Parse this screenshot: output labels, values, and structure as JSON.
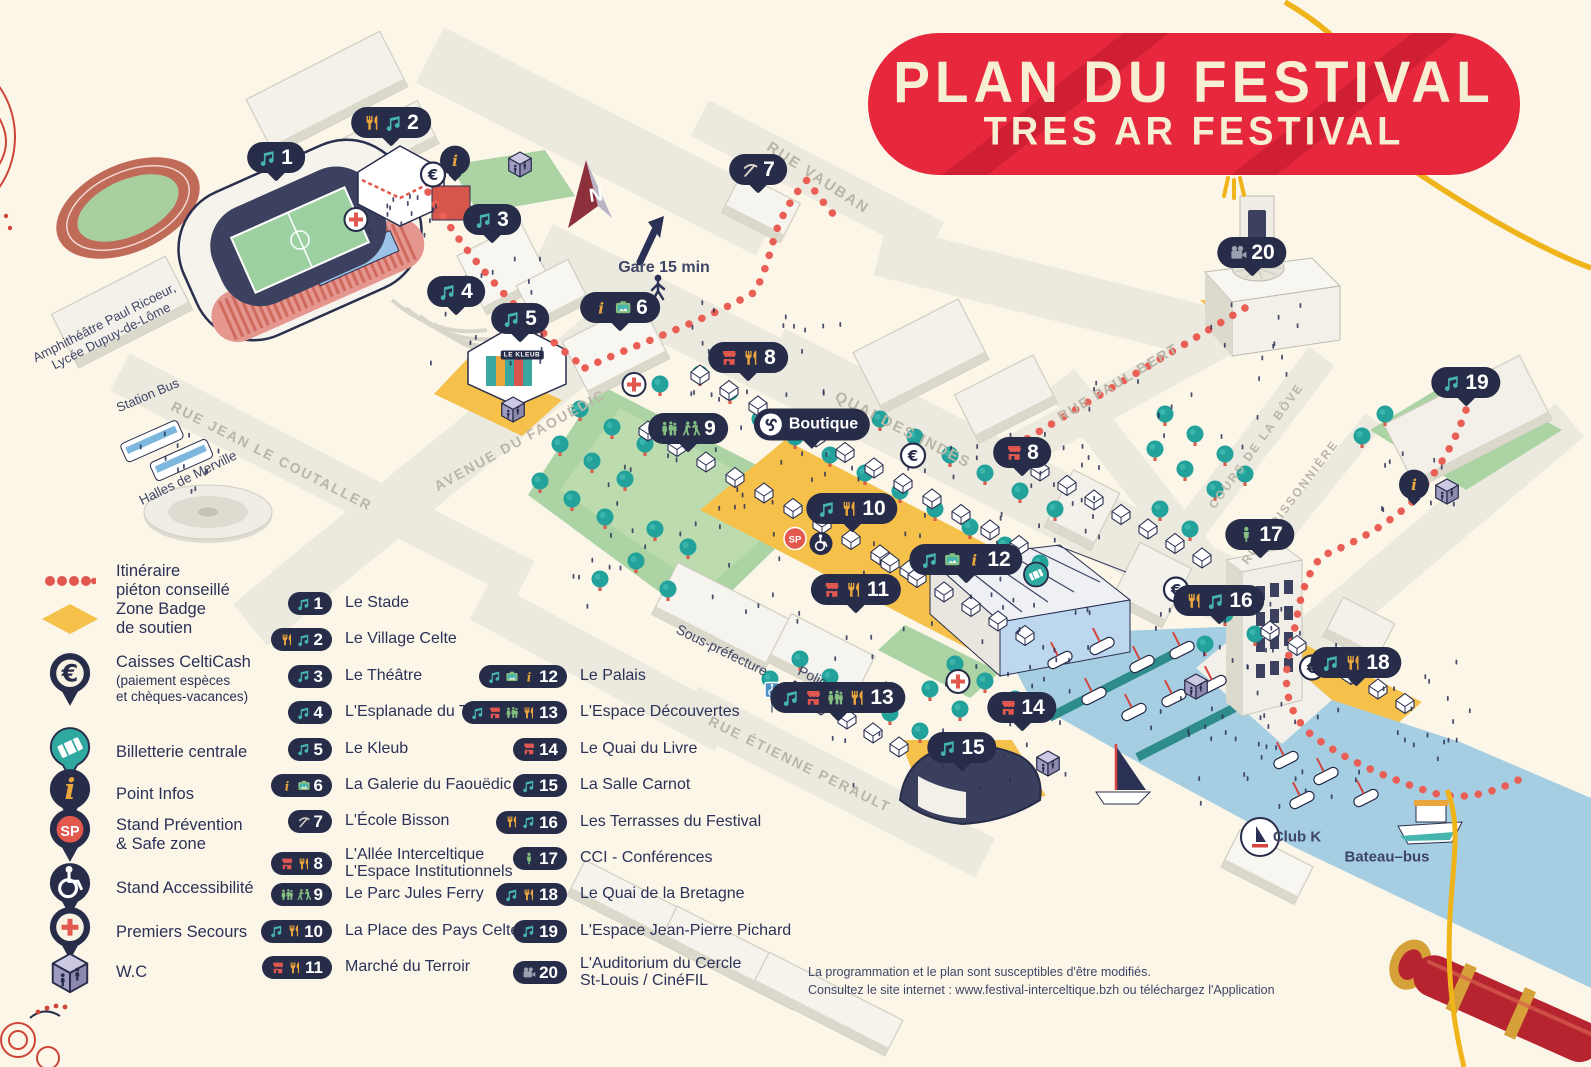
{
  "title": {
    "line1": "PLAN DU FESTIVAL",
    "line2": "TRES AR FESTIVAL"
  },
  "colors": {
    "banner_red": "#e7273c",
    "navy": "#272c49",
    "teal": "#45b5ad",
    "gold": "#eaa53d",
    "icon_red": "#e2574e",
    "icon_green": "#84bd80",
    "cream": "#fbf6e8",
    "water": "#a6cee2",
    "badge_yellow": "#f5c14b",
    "dotted_red": "#ea5f55"
  },
  "legend": {
    "items": [
      {
        "icon": "dotted-path",
        "label": [
          "Itinéraire",
          "piéton conseillé"
        ]
      },
      {
        "icon": "badge-zone",
        "label": [
          "Zone Badge",
          "de soutien"
        ]
      },
      {
        "icon": "euro-pin",
        "label": [
          "Caisses CeltiCash"
        ],
        "sub": [
          "(paiement espèces",
          "et chèques-vacances)"
        ]
      },
      {
        "icon": "ticket-pin",
        "label": [
          "Billetterie centrale"
        ]
      },
      {
        "icon": "info-pin",
        "label": [
          "Point Infos"
        ]
      },
      {
        "icon": "sp-pin",
        "label": [
          "Stand Prévention",
          "& Safe zone"
        ]
      },
      {
        "icon": "wheelchair-pin",
        "label": [
          "Stand Accessibilité"
        ]
      },
      {
        "icon": "firstaid-pin",
        "label": [
          "Premiers Secours"
        ]
      },
      {
        "icon": "wc-cube",
        "label": [
          "W.C"
        ]
      }
    ]
  },
  "locations": {
    "column1": [
      {
        "num": "1",
        "icons": [
          "music"
        ],
        "label": [
          "Le Stade"
        ]
      },
      {
        "num": "2",
        "icons": [
          "fork",
          "music"
        ],
        "label": [
          "Le Village Celte"
        ]
      },
      {
        "num": "3",
        "icons": [
          "music"
        ],
        "label": [
          "Le Théâtre"
        ]
      },
      {
        "num": "4",
        "icons": [
          "music"
        ],
        "label": [
          "L'Esplanade du Théâtre"
        ]
      },
      {
        "num": "5",
        "icons": [
          "music"
        ],
        "label": [
          "Le Kleub"
        ]
      },
      {
        "num": "6",
        "icons": [
          "info",
          "gallery"
        ],
        "label": [
          "La Galerie du Faouëdic"
        ]
      },
      {
        "num": "7",
        "icons": [
          "pickaxe"
        ],
        "label": [
          "L'École Bisson"
        ]
      },
      {
        "num": "8",
        "icons": [
          "shop",
          "fork"
        ],
        "label": [
          "L'Allée Interceltique",
          "L'Espace Institutionnels"
        ]
      },
      {
        "num": "9",
        "icons": [
          "people",
          "dancers"
        ],
        "label": [
          "Le Parc Jules Ferry"
        ]
      },
      {
        "num": "10",
        "icons": [
          "music",
          "fork"
        ],
        "label": [
          "La Place des Pays Celtes"
        ]
      },
      {
        "num": "11",
        "icons": [
          "shop",
          "fork"
        ],
        "label": [
          "Marché du Terroir"
        ]
      }
    ],
    "column2": [
      {
        "num": "12",
        "icons": [
          "music",
          "gallery",
          "info"
        ],
        "label": [
          "Le Palais"
        ]
      },
      {
        "num": "13",
        "icons": [
          "music",
          "shop",
          "people",
          "fork"
        ],
        "label": [
          "L'Espace Découvertes"
        ]
      },
      {
        "num": "14",
        "icons": [
          "shop"
        ],
        "label": [
          "Le Quai du Livre"
        ]
      },
      {
        "num": "15",
        "icons": [
          "music"
        ],
        "label": [
          "La Salle Carnot"
        ]
      },
      {
        "num": "16",
        "icons": [
          "fork",
          "music"
        ],
        "label": [
          "Les Terrasses du Festival"
        ]
      },
      {
        "num": "17",
        "icons": [
          "person"
        ],
        "label": [
          "CCI - Conférences"
        ]
      },
      {
        "num": "18",
        "icons": [
          "music",
          "fork"
        ],
        "label": [
          "Le Quai de la Bretagne"
        ]
      },
      {
        "num": "19",
        "icons": [
          "music"
        ],
        "label": [
          "L'Espace Jean-Pierre Pichard"
        ]
      },
      {
        "num": "20",
        "icons": [
          "filmcam"
        ],
        "label": [
          "L'Auditorium du Cercle",
          "St-Louis / CinéFIL"
        ]
      }
    ]
  },
  "map": {
    "markers": [
      {
        "num": "1",
        "icons": [
          "music"
        ],
        "x": 276,
        "y": 160
      },
      {
        "num": "2",
        "icons": [
          "fork",
          "music"
        ],
        "x": 391,
        "y": 125
      },
      {
        "num": "3",
        "icons": [
          "music"
        ],
        "x": 492,
        "y": 222
      },
      {
        "num": "4",
        "icons": [
          "music"
        ],
        "x": 456,
        "y": 294
      },
      {
        "num": "5",
        "icons": [
          "music"
        ],
        "x": 520,
        "y": 321
      },
      {
        "num": "6",
        "icons": [
          "info",
          "gallery"
        ],
        "x": 620,
        "y": 310
      },
      {
        "num": "7",
        "icons": [
          "pickaxe"
        ],
        "x": 758,
        "y": 172
      },
      {
        "num": "8",
        "icons": [
          "shop",
          "fork"
        ],
        "x": 748,
        "y": 360
      },
      {
        "num": "8",
        "icons": [
          "shop"
        ],
        "x": 1022,
        "y": 455
      },
      {
        "num": "9",
        "icons": [
          "people",
          "dancers"
        ],
        "x": 688,
        "y": 431
      },
      {
        "num": "10",
        "icons": [
          "music",
          "fork"
        ],
        "x": 852,
        "y": 511
      },
      {
        "num": "11",
        "icons": [
          "shop",
          "fork"
        ],
        "x": 856,
        "y": 592
      },
      {
        "num": "12",
        "icons": [
          "music",
          "gallery",
          "info"
        ],
        "x": 966,
        "y": 562
      },
      {
        "num": "13",
        "icons": [
          "music",
          "shop",
          "people",
          "fork"
        ],
        "x": 838,
        "y": 700
      },
      {
        "num": "14",
        "icons": [
          "shop"
        ],
        "x": 1022,
        "y": 710
      },
      {
        "num": "15",
        "icons": [
          "music"
        ],
        "x": 962,
        "y": 750
      },
      {
        "num": "16",
        "icons": [
          "fork",
          "music"
        ],
        "x": 1219,
        "y": 603
      },
      {
        "num": "17",
        "icons": [
          "person"
        ],
        "x": 1260,
        "y": 537
      },
      {
        "num": "18",
        "icons": [
          "music",
          "fork"
        ],
        "x": 1356,
        "y": 665
      },
      {
        "num": "19",
        "icons": [
          "music"
        ],
        "x": 1466,
        "y": 385
      },
      {
        "num": "20",
        "icons": [
          "filmcam"
        ],
        "x": 1252,
        "y": 255
      }
    ],
    "badges": [
      {
        "type": "euro",
        "x": 433,
        "y": 177
      },
      {
        "type": "plus",
        "x": 356,
        "y": 222
      },
      {
        "type": "wc",
        "x": 520,
        "y": 167
      },
      {
        "type": "wc",
        "x": 513,
        "y": 412
      },
      {
        "type": "plus",
        "x": 634,
        "y": 387
      },
      {
        "type": "euro",
        "x": 913,
        "y": 458
      },
      {
        "type": "sp",
        "x": 795,
        "y": 541
      },
      {
        "type": "wheel",
        "x": 821,
        "y": 546
      },
      {
        "type": "ticket",
        "x": 1036,
        "y": 577
      },
      {
        "type": "plus",
        "x": 958,
        "y": 684
      },
      {
        "type": "euro",
        "x": 1176,
        "y": 592
      },
      {
        "type": "euro",
        "x": 1312,
        "y": 670
      },
      {
        "type": "wc",
        "x": 1447,
        "y": 494
      },
      {
        "type": "wc",
        "x": 1196,
        "y": 689
      },
      {
        "type": "wc",
        "x": 1048,
        "y": 766
      },
      {
        "type": "wheel-sign",
        "x": 772,
        "y": 700
      }
    ],
    "info_bubbles": [
      {
        "x": 455,
        "y": 163
      },
      {
        "x": 1414,
        "y": 487
      }
    ],
    "street_labels": [
      {
        "text": "RUE VAUBAN",
        "x": 818,
        "y": 178,
        "a": 33,
        "s": 15
      },
      {
        "text": "RUE PAUL BERT",
        "x": 1118,
        "y": 382,
        "a": -31,
        "s": 14
      },
      {
        "text": "AVENUE DU FAOUËDIC",
        "x": 520,
        "y": 440,
        "a": -29,
        "s": 14
      },
      {
        "text": "RUE JEAN LE COUTALLER",
        "x": 272,
        "y": 456,
        "a": 27,
        "s": 14
      },
      {
        "text": "QUAI DES INDES",
        "x": 903,
        "y": 430,
        "a": 27,
        "s": 15
      },
      {
        "text": "COURS DE LA BÔVE",
        "x": 1256,
        "y": 446,
        "a": -54,
        "s": 12
      },
      {
        "text": "RUE POISSONNIÈRE",
        "x": 1290,
        "y": 502,
        "a": -53,
        "s": 12
      },
      {
        "text": "RUE ÉTIENNE PERAULT",
        "x": 800,
        "y": 764,
        "a": 26,
        "s": 14
      }
    ],
    "place_labels": [
      {
        "lines": [
          "Amphithéâtre Paul Ricoeur,",
          "Lycée Dupuy-de-Lôme"
        ],
        "x": 108,
        "y": 330,
        "a": -27,
        "s": 13
      },
      {
        "lines": [
          "Station Bus"
        ],
        "x": 148,
        "y": 396,
        "a": -23,
        "s": 13
      },
      {
        "lines": [
          "Halles de Merville"
        ],
        "x": 188,
        "y": 478,
        "a": -26,
        "s": 13.5
      },
      {
        "lines": [
          "Sous-préfecture"
        ],
        "x": 722,
        "y": 650,
        "a": 26,
        "s": 14
      },
      {
        "lines": [
          "Police"
        ],
        "x": 816,
        "y": 678,
        "a": 26,
        "s": 14
      },
      {
        "lines": [
          "Club K"
        ],
        "x": 1297,
        "y": 837,
        "a": 0,
        "s": 15,
        "bold": true
      },
      {
        "lines": [
          "Bateau–bus"
        ],
        "x": 1387,
        "y": 857,
        "a": 0,
        "s": 15,
        "bold": true
      },
      {
        "lines": [
          "Gare 15 min"
        ],
        "x": 664,
        "y": 268,
        "a": 0,
        "s": 16,
        "bold": true
      }
    ],
    "signs": [
      {
        "text": "LE KLEUB",
        "x": 522,
        "y": 355
      }
    ],
    "boutique": {
      "label": "Boutique",
      "x": 812,
      "y": 427
    },
    "compass_letter": "N"
  },
  "footer": {
    "line1": "La programmation et le plan sont susceptibles d'être modifiés.",
    "line2": "Consultez le site internet : www.festival-interceltique.bzh ou téléchargez l'Application"
  }
}
